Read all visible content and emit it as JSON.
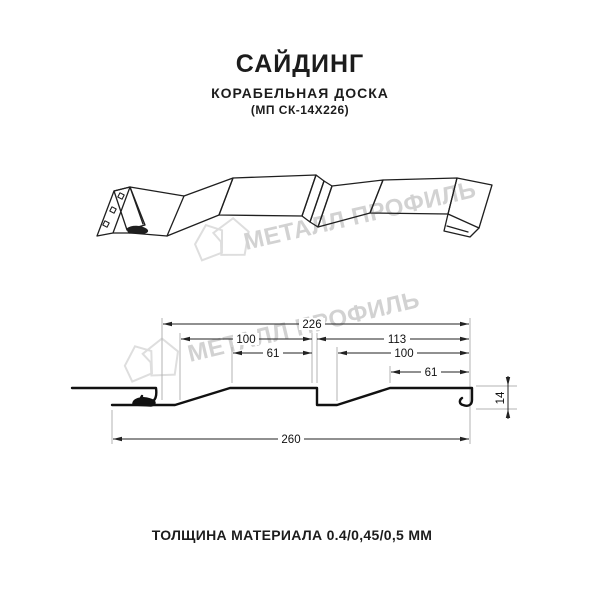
{
  "header": {
    "title": "САЙДИНГ",
    "subtitle": "КОРАБЕЛЬНАЯ ДОСКА",
    "code": "(МП СК-14Х226)"
  },
  "watermark": {
    "text": "МЕТАЛЛ ПРОФИЛЬ",
    "color": "#d2d2d2"
  },
  "dimensions": {
    "overall_width": "226",
    "module_left": "100",
    "module_right": "113",
    "plateau_left": "61",
    "inner_right": "100",
    "plateau_right": "61",
    "total_width": "260",
    "height": "14"
  },
  "footer": {
    "thickness": "ТОЛЩИНА МАТЕРИАЛА 0.4/0,45/0,5 ММ"
  },
  "colors": {
    "line": "#1f1f1f",
    "dimension": "#222222",
    "extension": "#b3b3b3",
    "watermark": "#d2d2d2"
  }
}
